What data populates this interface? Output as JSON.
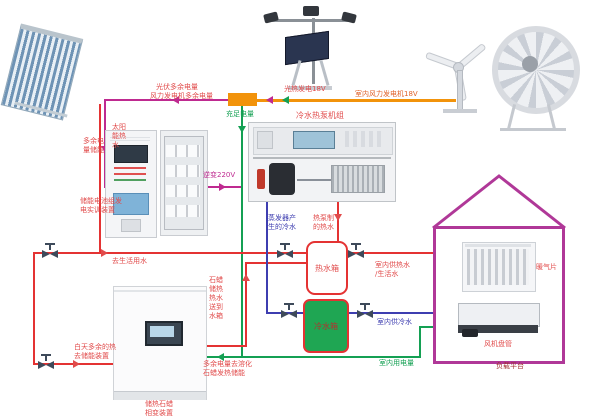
{
  "diagram_title": "太阳能/风能/热泵综合能源实训系统",
  "colors": {
    "hot_water_line": "#e43333",
    "cold_water_line": "#3e3eb0",
    "electric_line": "#14a053",
    "surplus_line": "#bf2a90",
    "generation_line": "#f2930b",
    "house_outline": "#b03898",
    "cold_tank_fill": "#1fa653"
  },
  "labels": {
    "pv_surplus": "光伏多余电量",
    "wind_surplus": "风力发电机多余电量",
    "sufficient_power": "充足电量",
    "pv_generation": "光热发电18V",
    "indoor_wind_generator": "室内风力发电机18V",
    "solar_hot_water": "太阳能热水",
    "surplus_storage": "多余电量储能",
    "battery_device": [
      "储能电池组发",
      "电实训装置"
    ],
    "inverter": "逆变220V",
    "heat_pump_unit": "冷水热泵机组",
    "evap_cold_water": [
      "蒸发器产",
      "生的冷水"
    ],
    "hp_hot_water": [
      "热泵制",
      "的热水"
    ],
    "to_domestic_water": "去生活用水",
    "hot_tank": "热水箱",
    "cold_tank": "冷水箱",
    "indoor_hot_supply": [
      "室内供热水",
      "/生活水"
    ],
    "indoor_cold_supply": "室内供冷水",
    "day_surplus_heat": [
      "白天多余的热",
      "去储能装置"
    ],
    "paraffin_to_tank": "石蜡储热热水送到水箱",
    "surplus_melt_paraffin": [
      "多余电量去溶化",
      "石蜡发热储能"
    ],
    "phase_change_device": [
      "储热石蜡",
      "相变装置"
    ],
    "indoor_power_use": "室内用电量",
    "radiator": "暖气片",
    "fan_coil": "风机盘管",
    "load_platform": "负载平台"
  },
  "components": {
    "solar_collector": "solar-thermal-collector",
    "pv_tracker": "pv-tracker-with-lamps",
    "wind_turbine": "small-wind-turbine",
    "wind_tunnel_fan": "wind-tunnel-fan",
    "battery_cabinet": "battery-control-cabinet",
    "storage_cabinet": "battery-rack-cabinet",
    "heat_pump": "water-heat-pump-bench",
    "hot_tank": "hot-water-tank",
    "cold_tank": "cold-water-tank",
    "phase_change_cabinet": "paraffin-phase-change-cabinet",
    "house": "load-house",
    "radiator": "radiator-panel",
    "fan_coil": "fan-coil-unit",
    "valve": "gate-valve",
    "junction": "power-junction-box"
  }
}
